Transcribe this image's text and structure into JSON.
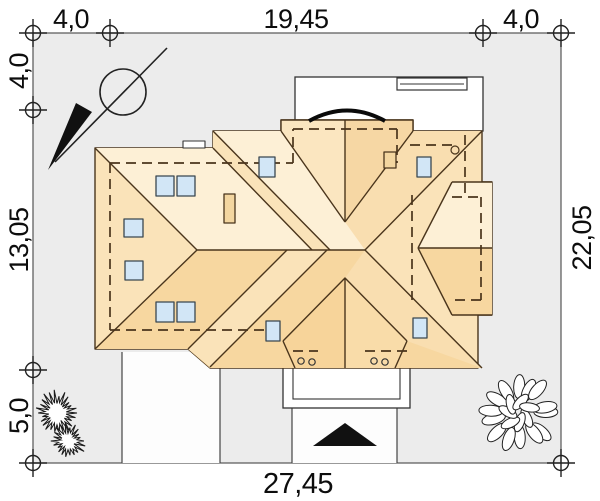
{
  "drawing": {
    "kind": "house-site-plan-roof-view",
    "dimensions": {
      "top": [
        "4,0",
        "19,45",
        "4,0"
      ],
      "left": [
        "4,0",
        "13,05",
        "5,0"
      ],
      "right": [
        "22,05"
      ],
      "bottom": [
        "27,45"
      ]
    }
  },
  "colors": {
    "plot_fill": "#ececec",
    "roof_light": "#fdf0d6",
    "roof_mid": "#fae3b9",
    "roof_dark": "#f7d7a0",
    "roof_wedge": "#f9deb0",
    "skylight": "#d2e6f6",
    "outline": "#4a351c",
    "entrance_arrow": "#111111"
  },
  "symbols": {
    "north_arrow": "north-arrow",
    "survey_marker": "survey-marker-cross-circle",
    "entrance_arrow": "entrance-direction-triangle",
    "shrub": "spiky-shrub",
    "tree": "leafy-tree"
  }
}
